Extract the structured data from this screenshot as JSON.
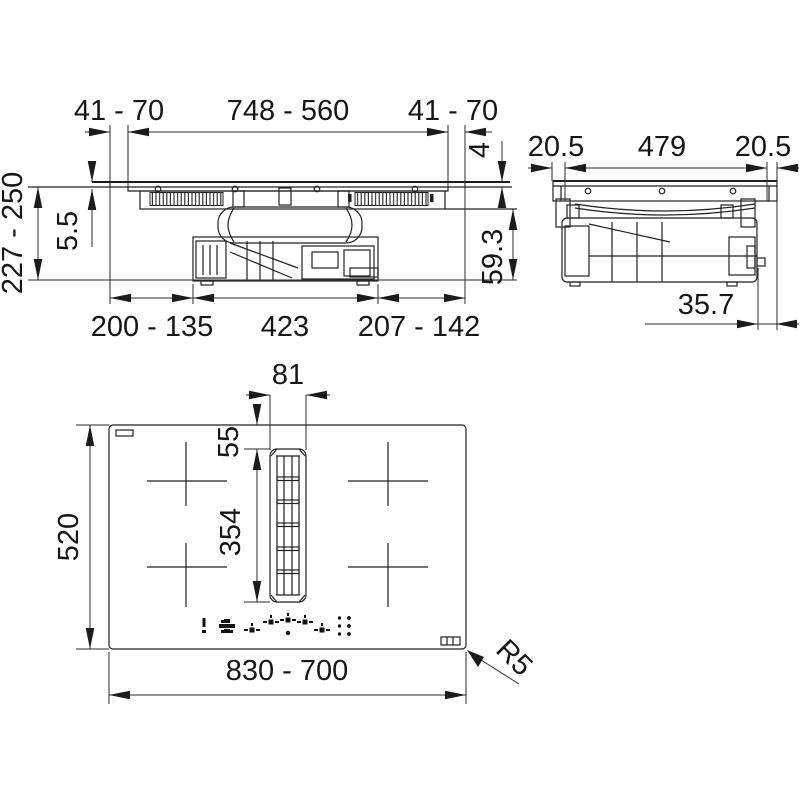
{
  "drawing_title": "Hob with downdraft extractor installation drawing",
  "colors": {
    "line": "#222222",
    "dimension_line": "#2a2a2a",
    "text": "#161616",
    "background": "#ffffff"
  },
  "front_view": {
    "dims": {
      "cutout_left": "41 - 70",
      "cutout_width": "748 - 560",
      "cutout_right": "41 - 70",
      "height_range": "227 - 250",
      "glass_lip": "5.5",
      "glass_proud": "4",
      "duct_height": "59.3",
      "bottom_left": "200 - 135",
      "motor_width": "423",
      "bottom_right": "207 - 142"
    }
  },
  "side_view": {
    "dims": {
      "overhang_left": "20.5",
      "body_depth": "479",
      "overhang_right": "20.5",
      "shaft_offset": "35.7"
    }
  },
  "plan_view": {
    "dims": {
      "vent_width": "81",
      "vent_offset": "55",
      "vent_length": "354",
      "hob_depth": "520",
      "hob_width": "830 - 700",
      "corner_radius": "R5"
    },
    "icons": [
      "power-icon",
      "auto-boost-icon",
      "zone-rear-left-icon",
      "zone-front-left-icon",
      "hood-zone-icon",
      "zone-front-right-icon",
      "zone-rear-right-icon",
      "intensity-dots-icon"
    ]
  }
}
